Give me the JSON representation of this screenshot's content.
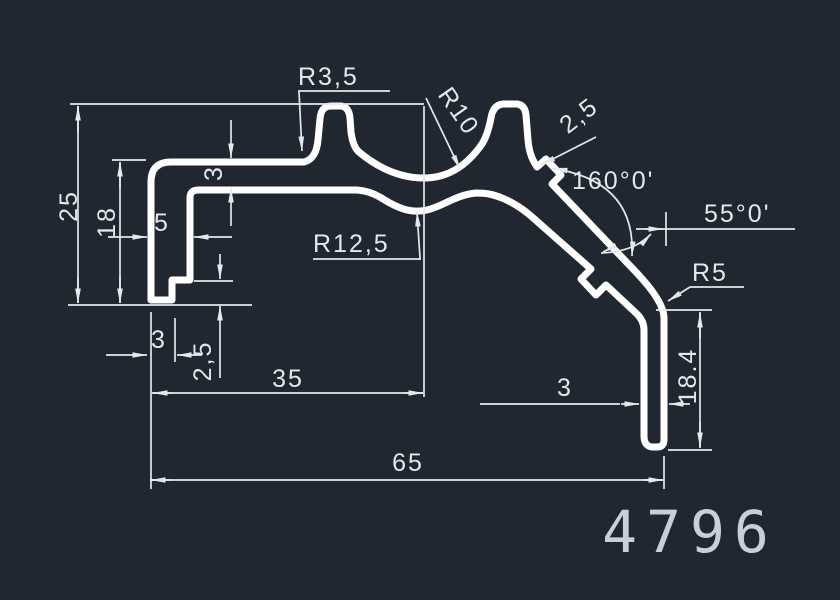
{
  "drawing_number": "4796",
  "colors": {
    "background": "#212731",
    "profile": "#ffffff",
    "dimension": "#e4e8eb",
    "title": "#c9cfd7"
  },
  "dimensions": {
    "height_total": "25",
    "height_inner": "18",
    "flange_thickness": "3",
    "wall_width": "5",
    "foot_step_height": "2,5",
    "foot_width": "3",
    "width_to_valley": "35",
    "width_total": "65",
    "leg_thickness": "3",
    "leg_height": "18.4",
    "radius_bump": "R3,5",
    "radius_valley_outer": "R10",
    "radius_valley_inner": "R12,5",
    "radius_leg_corner": "R5",
    "rib_thickness": "2,5",
    "angle_bend": "160°0'",
    "angle_leg": "55°0'"
  }
}
